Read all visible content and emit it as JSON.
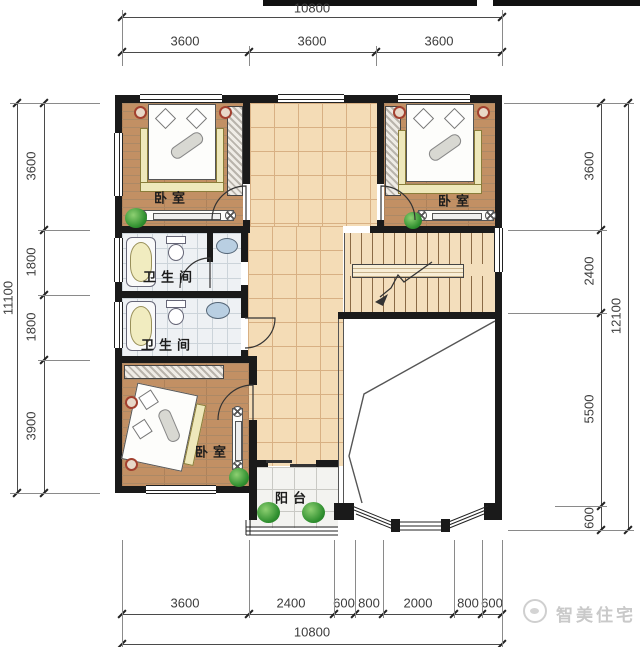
{
  "drawing": {
    "kind": "residential floor plan, second storey"
  },
  "dims": {
    "top": {
      "total": "10800",
      "segments": [
        "3600",
        "3600",
        "3600"
      ]
    },
    "left": {
      "total": "11100",
      "segments": [
        "3600",
        "1800",
        "1800",
        "3900"
      ]
    },
    "right": {
      "total": "12100",
      "segments": [
        "3600",
        "2400",
        "5500",
        "600"
      ]
    },
    "bottom": {
      "total": "10800",
      "segments": [
        "3600",
        "2400",
        "600",
        "800",
        "2000",
        "800",
        "600"
      ]
    }
  },
  "rooms": {
    "bedroom_top_left": {
      "label": "卧室"
    },
    "bedroom_top_right": {
      "label": "卧室"
    },
    "bathroom_upper": {
      "label": "卫生间"
    },
    "bathroom_lower": {
      "label": "卫生间"
    },
    "bedroom_bottom_left": {
      "label": "卧室"
    },
    "balcony": {
      "label": "阳台"
    }
  },
  "watermark": {
    "brand": "智美住宅"
  },
  "colors": {
    "wall": "#1a1a1a",
    "wood_floor": "#c29064",
    "hall_tile": "#f4dcb6",
    "bath_tile": "#eef1f4",
    "marble_tile": "#f3f3f0",
    "plant_green": "#2f8f2f",
    "dimension_text": "#3c3c3c",
    "watermark_gray": "#c9c9c9",
    "bathtub_fill": "#f1ecc0",
    "sink_fill": "#b9cfe2"
  }
}
